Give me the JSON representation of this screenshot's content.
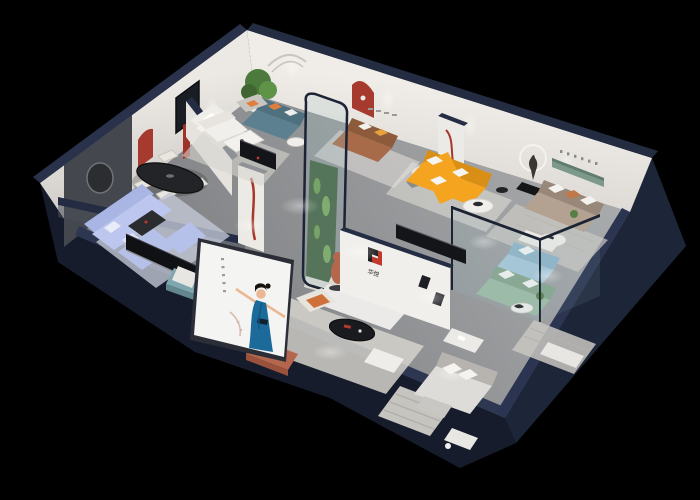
{
  "scene": {
    "description": "Isometric 3D cutaway render of a furniture showroom floor plan on a black background",
    "view": "isometric cutaway",
    "background": "#000000"
  },
  "branding": {
    "logo_text": "华悦",
    "logo_mark": "two-tone geometric H monogram",
    "logo_black": "#1d1d1d",
    "logo_red": "#c0392b"
  },
  "poster": {
    "subject": "woman in blue dress with outstretched arms",
    "panel_color": "#f4f4f2",
    "dress_color": "#1b6a99",
    "vertical_caption_legible": false
  },
  "palette": {
    "wall_top_navy": "#28314a",
    "wall_face": "#e9e6e1",
    "floor_gray": "#8f9194",
    "arch_red": "#a63a2e",
    "orange_sofa": "#f4a41f",
    "orange_sofa_shade": "#d98f15",
    "periwinkle_sofa": "#bcc6ee",
    "teal_sofa": "#5d8090",
    "brown_sofa": "#a76b4a",
    "taupe_sofa": "#b3a291",
    "sage_sofa": "#9cbaa3",
    "blue_sofa": "#a6c6d8",
    "terracotta": "#b5674d",
    "plant_green": "#4c7a3c",
    "shelf_green": "#7c998c",
    "glass_frame": "#1c2434",
    "console_black": "#141519"
  },
  "rooms": [
    {
      "name": "living-room-periwinkle",
      "items": [
        "periwinkle sectional sofa",
        "dark coffee table",
        "black media console",
        "teal ottoman",
        "dark feature wall with round mirror",
        "red arch niche"
      ]
    },
    {
      "name": "dining-area",
      "items": [
        "black oval dining table",
        "four cream chairs",
        "red arch niche",
        "tall red display panel",
        "black framed wall art"
      ]
    },
    {
      "name": "lounge-white",
      "items": [
        "white modular sofa",
        "white coffee table",
        "black media console",
        "potted tree",
        "teal fabric sofa with orange pillows",
        "gray armchair"
      ]
    },
    {
      "name": "showroom-orange",
      "items": [
        "orange L-shaped sofa",
        "white round coffee table",
        "brown leather sofa",
        "sculpture with ring light",
        "curved glass plant display",
        "red ribbon wall art"
      ]
    },
    {
      "name": "lounge-taupe",
      "items": [
        "taupe three-seat sofa",
        "green recessed wall shelf",
        "round coffee table",
        "spaced wall lettering"
      ]
    },
    {
      "name": "glass-lounge",
      "items": [
        "sage green sofa",
        "light blue loveseat",
        "navy framed glass partitions",
        "round side table"
      ]
    },
    {
      "name": "bedroom-display",
      "items": [
        "white sofa with terracotta cushions",
        "black oval coffee table",
        "white ottoman",
        "terracotta bench",
        "terracotta figure sculpture",
        "brand logo wall"
      ]
    },
    {
      "name": "bedroom-gray",
      "items": [
        "gray upholstered bed",
        "striped rug",
        "white desk set"
      ]
    }
  ]
}
